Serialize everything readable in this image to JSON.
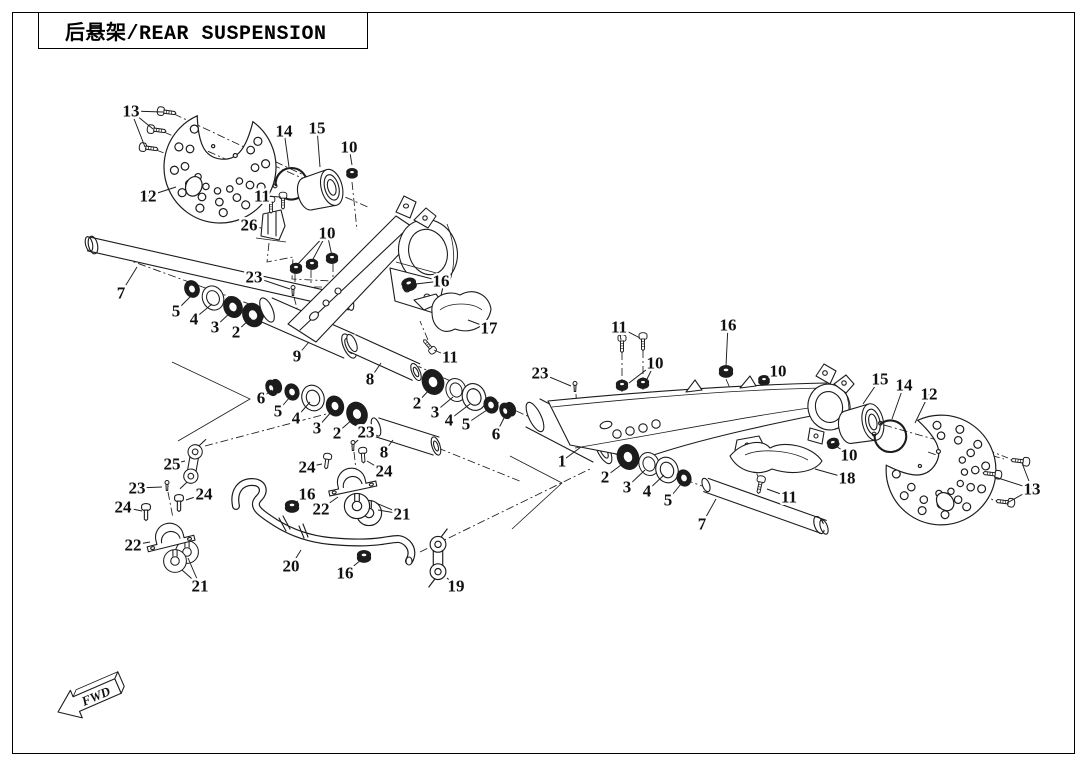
{
  "title": {
    "text": "后悬架/REAR SUSPENSION"
  },
  "diagram": {
    "fwd_label": "FWD",
    "ink_color": "#1c1c1c",
    "callouts": [
      {
        "n": "13",
        "x": 131,
        "y": 111,
        "to": [
          [
            163,
            112
          ],
          [
            153,
            129
          ],
          [
            145,
            147
          ]
        ]
      },
      {
        "n": "12",
        "x": 148,
        "y": 196,
        "to": [
          [
            176,
            187
          ]
        ]
      },
      {
        "n": "14",
        "x": 284,
        "y": 131,
        "to": [
          [
            289,
            167
          ]
        ]
      },
      {
        "n": "15",
        "x": 317,
        "y": 128,
        "to": [
          [
            320,
            167
          ]
        ]
      },
      {
        "n": "10",
        "x": 349,
        "y": 147,
        "to": [
          [
            352,
            165
          ]
        ]
      },
      {
        "n": "11",
        "x": 262,
        "y": 196,
        "to": [
          [
            269,
            200
          ],
          [
            281,
            197
          ]
        ]
      },
      {
        "n": "26",
        "x": 249,
        "y": 225,
        "to": [
          [
            261,
            228
          ]
        ]
      },
      {
        "n": "10",
        "x": 327,
        "y": 233,
        "to": [
          [
            297,
            265
          ],
          [
            312,
            261
          ],
          [
            332,
            256
          ]
        ]
      },
      {
        "n": "23",
        "x": 254,
        "y": 277,
        "to": [
          [
            290,
            289
          ]
        ]
      },
      {
        "n": "7",
        "x": 121,
        "y": 293,
        "to": [
          [
            137,
            267
          ]
        ]
      },
      {
        "n": "5",
        "x": 176,
        "y": 311,
        "to": [
          [
            191,
            296
          ]
        ]
      },
      {
        "n": "4",
        "x": 194,
        "y": 319,
        "to": [
          [
            212,
            304
          ]
        ]
      },
      {
        "n": "3",
        "x": 215,
        "y": 327,
        "to": [
          [
            231,
            312
          ]
        ]
      },
      {
        "n": "2",
        "x": 236,
        "y": 332,
        "to": [
          [
            251,
            318
          ]
        ]
      },
      {
        "n": "9",
        "x": 297,
        "y": 356,
        "to": [
          [
            309,
            342
          ]
        ]
      },
      {
        "n": "16",
        "x": 441,
        "y": 281,
        "to": [
          [
            416,
            284
          ]
        ]
      },
      {
        "n": "17",
        "x": 489,
        "y": 328,
        "to": [
          [
            468,
            320
          ]
        ]
      },
      {
        "n": "11",
        "x": 450,
        "y": 357,
        "to": [
          [
            434,
            350
          ]
        ]
      },
      {
        "n": "8",
        "x": 370,
        "y": 379,
        "to": [
          [
            381,
            363
          ]
        ]
      },
      {
        "n": "2",
        "x": 417,
        "y": 403,
        "to": [
          [
            430,
            389
          ]
        ]
      },
      {
        "n": "3",
        "x": 435,
        "y": 412,
        "to": [
          [
            453,
            397
          ]
        ]
      },
      {
        "n": "4",
        "x": 449,
        "y": 420,
        "to": [
          [
            470,
            404
          ]
        ]
      },
      {
        "n": "5",
        "x": 466,
        "y": 424,
        "to": [
          [
            487,
            410
          ]
        ]
      },
      {
        "n": "6",
        "x": 496,
        "y": 434,
        "to": [
          [
            505,
            416
          ]
        ]
      },
      {
        "n": "6",
        "x": 261,
        "y": 398,
        "to": [
          [
            272,
            390
          ]
        ]
      },
      {
        "n": "5",
        "x": 278,
        "y": 411,
        "to": [
          [
            290,
            397
          ]
        ]
      },
      {
        "n": "4",
        "x": 296,
        "y": 418,
        "to": [
          [
            310,
            402
          ]
        ]
      },
      {
        "n": "3",
        "x": 317,
        "y": 428,
        "to": [
          [
            333,
            410
          ]
        ]
      },
      {
        "n": "2",
        "x": 337,
        "y": 433,
        "to": [
          [
            354,
            418
          ]
        ]
      },
      {
        "n": "23",
        "x": 366,
        "y": 432,
        "to": [
          [
            355,
            443
          ]
        ]
      },
      {
        "n": "8",
        "x": 384,
        "y": 452,
        "to": [
          [
            393,
            440
          ]
        ]
      },
      {
        "n": "24",
        "x": 307,
        "y": 467,
        "to": [
          [
            322,
            464
          ]
        ]
      },
      {
        "n": "24",
        "x": 384,
        "y": 471,
        "to": [
          [
            367,
            461
          ]
        ]
      },
      {
        "n": "16",
        "x": 307,
        "y": 494,
        "to": [
          [
            295,
            503
          ]
        ]
      },
      {
        "n": "22",
        "x": 321,
        "y": 509,
        "to": [
          [
            338,
            497
          ]
        ]
      },
      {
        "n": "21",
        "x": 402,
        "y": 514,
        "to": [
          [
            378,
            510
          ],
          [
            376,
            503
          ]
        ]
      },
      {
        "n": "25",
        "x": 172,
        "y": 464,
        "to": [
          [
            185,
            461
          ]
        ]
      },
      {
        "n": "23",
        "x": 137,
        "y": 488,
        "to": [
          [
            162,
            487
          ]
        ]
      },
      {
        "n": "24",
        "x": 123,
        "y": 507,
        "to": [
          [
            142,
            511
          ]
        ]
      },
      {
        "n": "24",
        "x": 204,
        "y": 494,
        "to": [
          [
            186,
            500
          ]
        ]
      },
      {
        "n": "22",
        "x": 133,
        "y": 545,
        "to": [
          [
            150,
            542
          ]
        ]
      },
      {
        "n": "21",
        "x": 200,
        "y": 586,
        "to": [
          [
            182,
            570
          ],
          [
            188,
            558
          ]
        ]
      },
      {
        "n": "20",
        "x": 291,
        "y": 566,
        "to": [
          [
            301,
            550
          ]
        ]
      },
      {
        "n": "16",
        "x": 345,
        "y": 573,
        "to": [
          [
            361,
            560
          ]
        ]
      },
      {
        "n": "19",
        "x": 456,
        "y": 586,
        "to": [
          [
            447,
            578
          ]
        ]
      },
      {
        "n": "23",
        "x": 540,
        "y": 373,
        "to": [
          [
            571,
            386
          ]
        ]
      },
      {
        "n": "1",
        "x": 562,
        "y": 461,
        "to": [
          [
            581,
            447
          ]
        ]
      },
      {
        "n": "11",
        "x": 619,
        "y": 327,
        "to": [
          [
            621,
            340
          ],
          [
            640,
            338
          ]
        ]
      },
      {
        "n": "10",
        "x": 655,
        "y": 363,
        "to": [
          [
            629,
            383
          ],
          [
            646,
            381
          ]
        ]
      },
      {
        "n": "16",
        "x": 728,
        "y": 325,
        "to": [
          [
            726,
            366
          ]
        ]
      },
      {
        "n": "10",
        "x": 778,
        "y": 371,
        "to": [
          [
            768,
            378
          ]
        ]
      },
      {
        "n": "2",
        "x": 605,
        "y": 477,
        "to": [
          [
            625,
            462
          ]
        ]
      },
      {
        "n": "3",
        "x": 627,
        "y": 487,
        "to": [
          [
            645,
            470
          ]
        ]
      },
      {
        "n": "4",
        "x": 647,
        "y": 491,
        "to": [
          [
            664,
            475
          ]
        ]
      },
      {
        "n": "5",
        "x": 668,
        "y": 500,
        "to": [
          [
            681,
            484
          ]
        ]
      },
      {
        "n": "7",
        "x": 702,
        "y": 524,
        "to": [
          [
            716,
            499
          ]
        ]
      },
      {
        "n": "11",
        "x": 789,
        "y": 497,
        "to": [
          [
            767,
            489
          ]
        ]
      },
      {
        "n": "18",
        "x": 847,
        "y": 478,
        "to": [
          [
            815,
            469
          ]
        ]
      },
      {
        "n": "10",
        "x": 849,
        "y": 455,
        "to": [
          [
            836,
            446
          ]
        ]
      },
      {
        "n": "15",
        "x": 880,
        "y": 379,
        "to": [
          [
            863,
            404
          ]
        ]
      },
      {
        "n": "14",
        "x": 904,
        "y": 385,
        "to": [
          [
            892,
            419
          ]
        ]
      },
      {
        "n": "12",
        "x": 929,
        "y": 394,
        "to": [
          [
            915,
            423
          ]
        ]
      },
      {
        "n": "13",
        "x": 1032,
        "y": 489,
        "to": [
          [
            1022,
            463
          ],
          [
            995,
            477
          ],
          [
            1007,
            503
          ]
        ]
      }
    ]
  }
}
